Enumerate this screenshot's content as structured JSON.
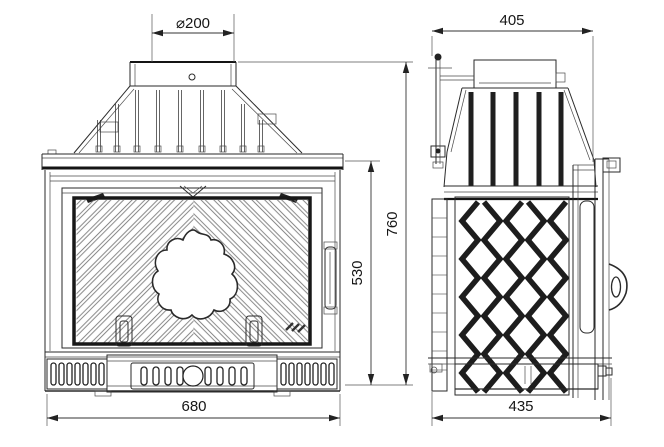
{
  "drawing": {
    "kind": "fireplace-insert-two-view-dimensional-drawing",
    "background_color": "#ffffff",
    "line_color": "#1f1f1f",
    "views": {
      "front": {
        "name": "front elevation"
      },
      "side": {
        "name": "side elevation"
      }
    },
    "dimensions": {
      "flue_diameter": {
        "label": "⌀200",
        "value": 200
      },
      "side_top_width": {
        "label": "405",
        "value": 405
      },
      "overall_height": {
        "label": "760",
        "value": 760
      },
      "firebox_height": {
        "label": "530",
        "value": 530
      },
      "overall_width": {
        "label": "680",
        "value": 680
      },
      "overall_depth": {
        "label": "435",
        "value": 435
      }
    }
  }
}
